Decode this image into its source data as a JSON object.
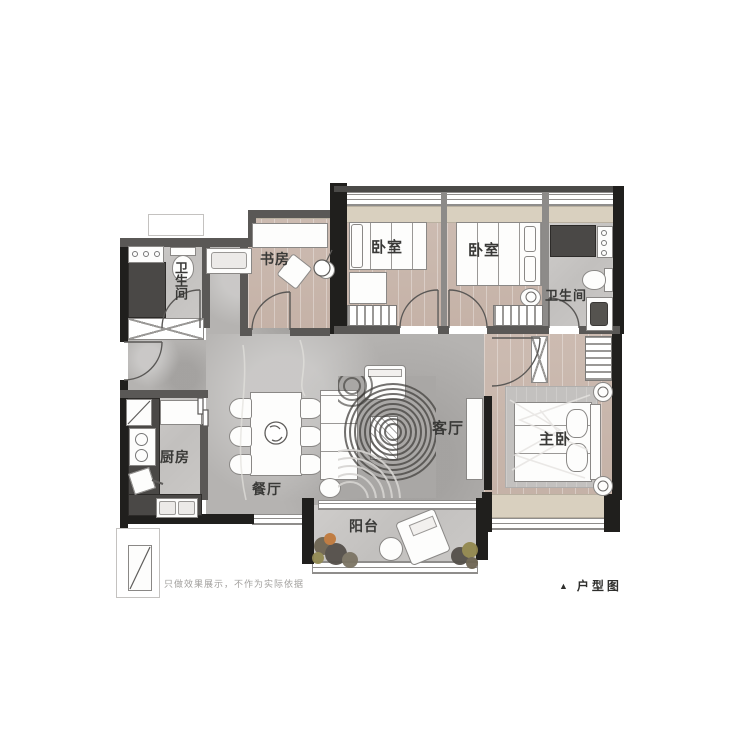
{
  "rooms": {
    "bathroom_left": {
      "label": "卫生间"
    },
    "study": {
      "label": "书房"
    },
    "bedroom_a": {
      "label": "卧室"
    },
    "bedroom_b": {
      "label": "卧室"
    },
    "bathroom_right": {
      "label": "卫生间"
    },
    "kitchen": {
      "label": "厨房"
    },
    "dining": {
      "label": "餐厅"
    },
    "living": {
      "label": "客厅"
    },
    "master_bedroom": {
      "label": "主卧"
    },
    "balcony": {
      "label": "阳台"
    }
  },
  "footer": {
    "disclaimer": "只做效果展示，不作为实际依据",
    "legend_marker": "▲",
    "legend_label": "户型图"
  },
  "colors": {
    "wall_black": "#201f1d",
    "wall_gray": "#5a5856",
    "floor_concrete": "#b5b3b1",
    "floor_wood": "#c8b5aa",
    "floor_tile": "#c6c4c2",
    "bay_beige": "#d9d0bf",
    "counter_dark": "#4a4846",
    "furniture_white": "#fdfdfc"
  }
}
